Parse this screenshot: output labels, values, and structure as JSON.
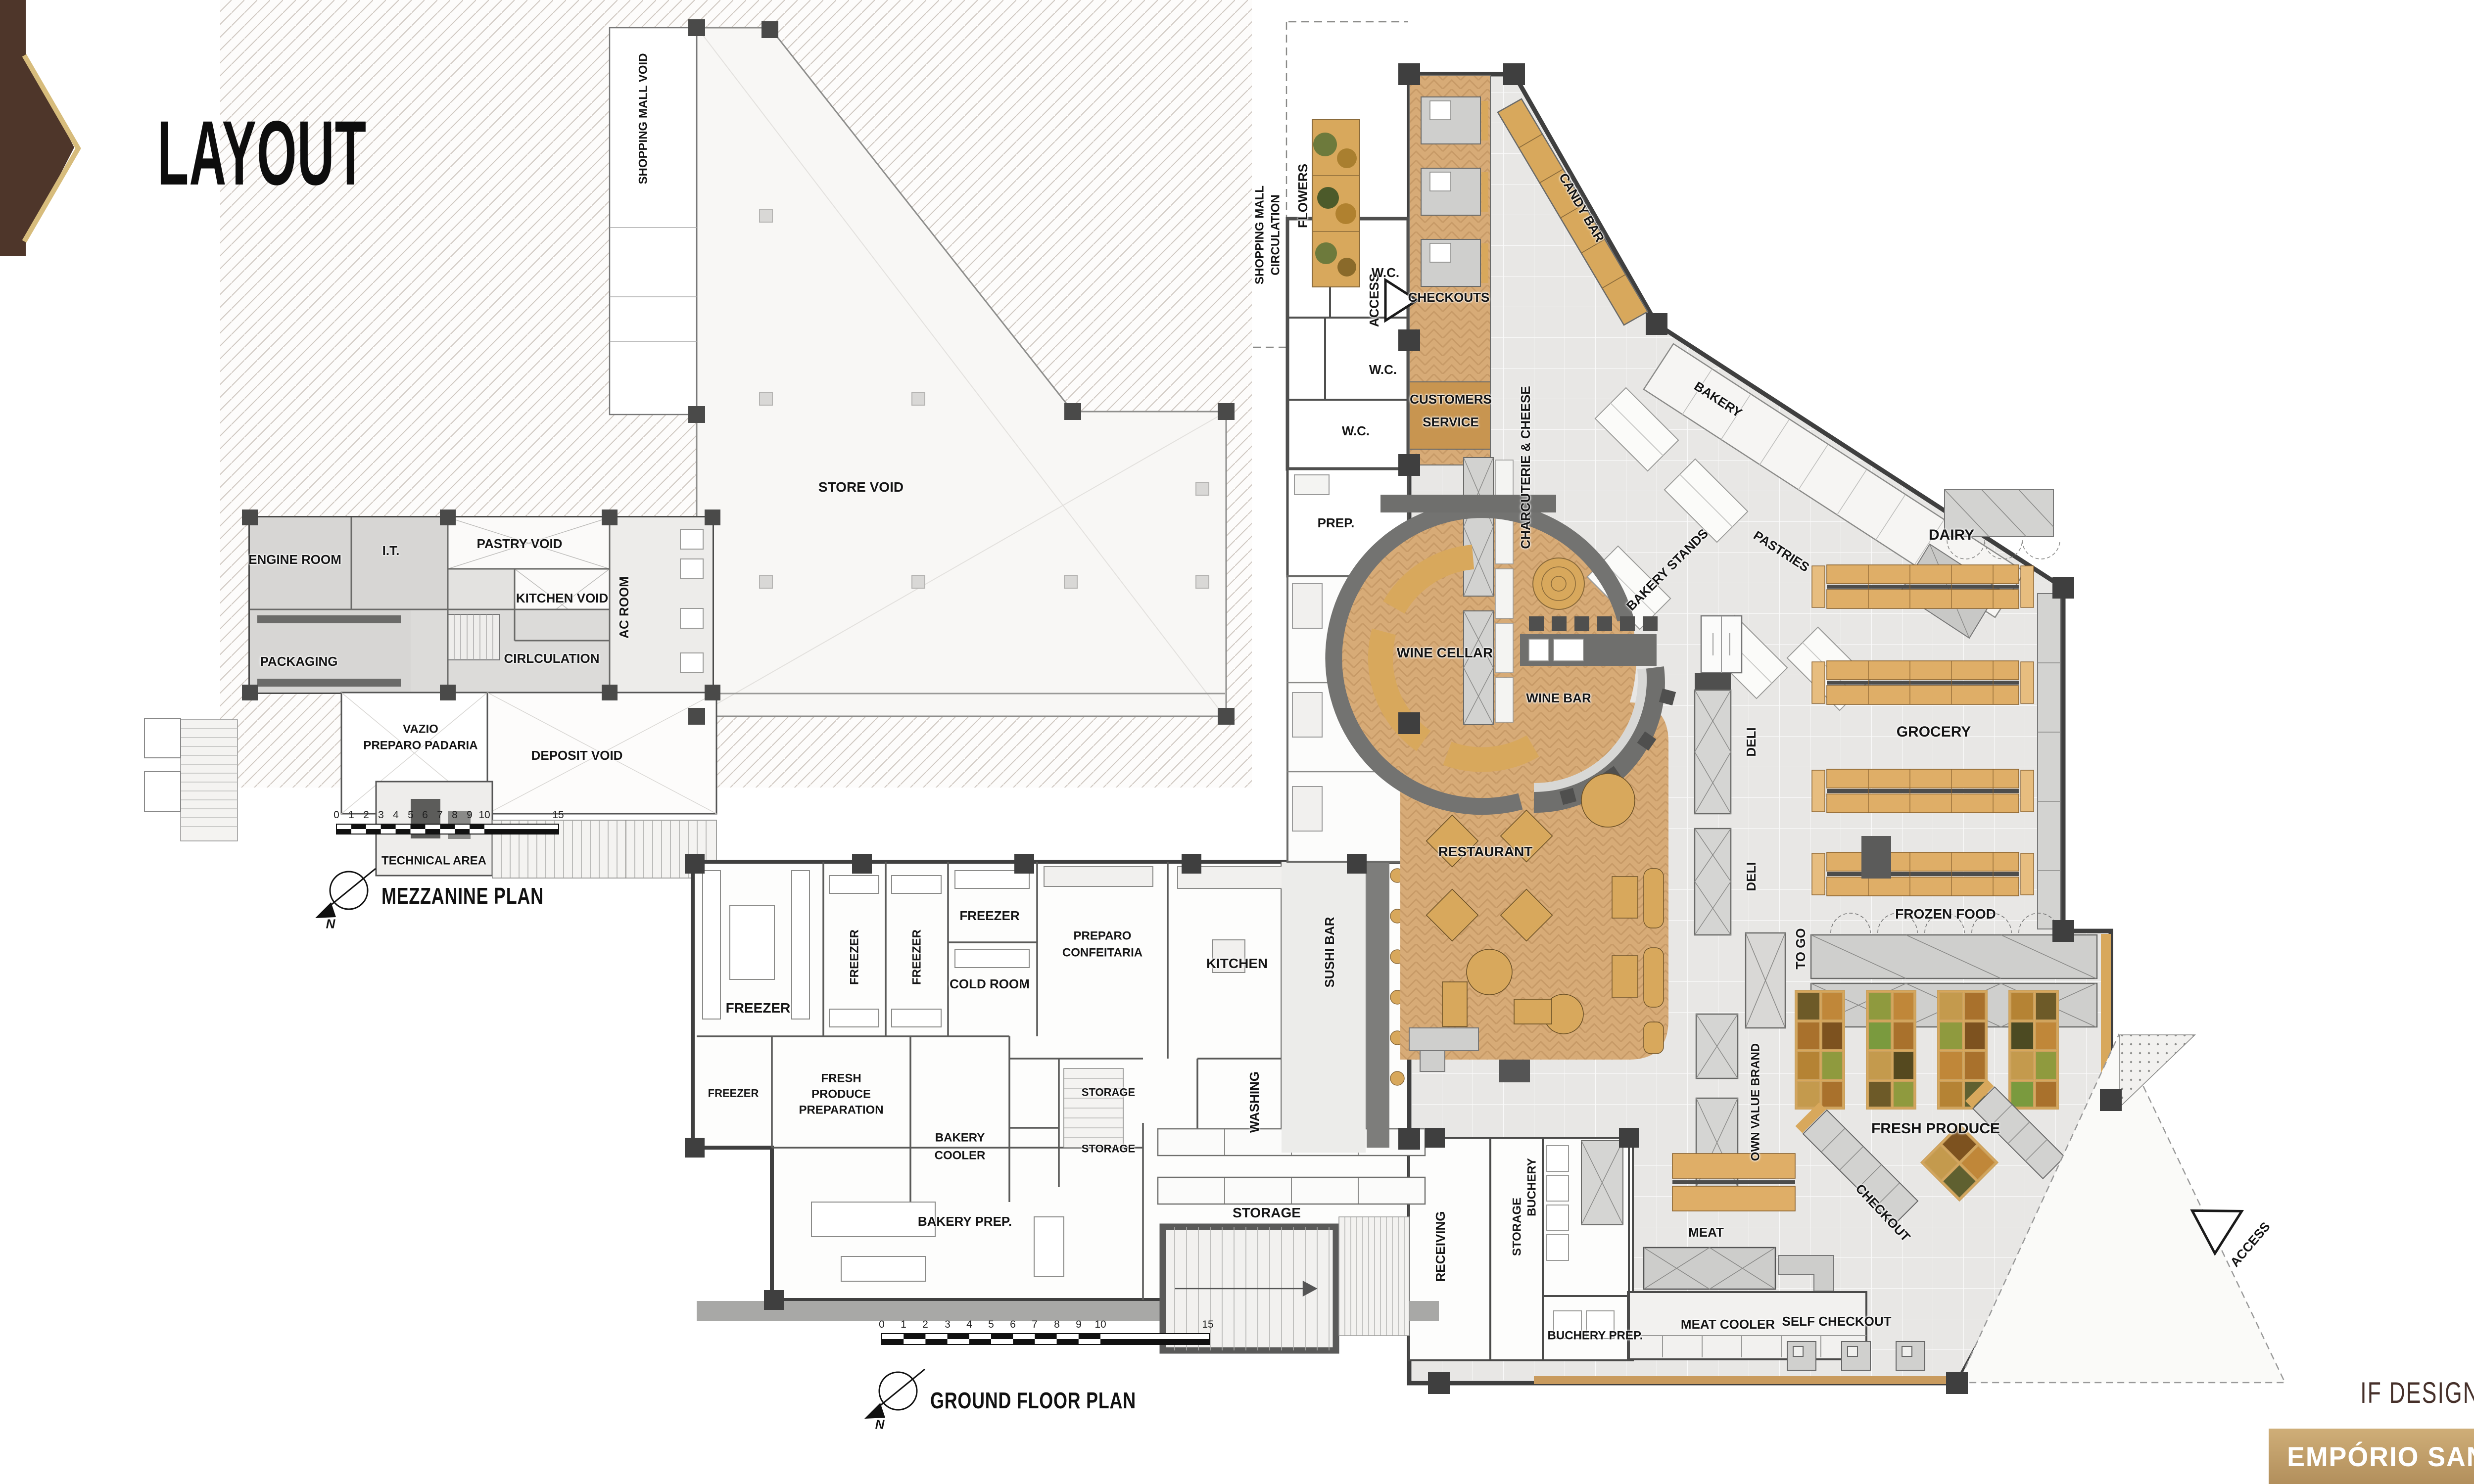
{
  "slide": {
    "title": "LAYOUT"
  },
  "footer": {
    "award": "IF DESIGN AWARD 2023",
    "brand": "EMPÓRIO SANTA MARIA"
  },
  "colors": {
    "accent_brown": "#4e362a",
    "accent_gold": "#d7bc7c",
    "band_tan": "#c2a16d",
    "wood": "#d7ab77",
    "shelf_orange": "#dfae67",
    "floor_gray": "#e8e7e5",
    "wall_dark": "#3f3f3f"
  },
  "mezzanine": {
    "title": "MEZZANINE PLAN",
    "north": "N",
    "scale_ticks": [
      "0",
      "1",
      "2",
      "3",
      "4",
      "5",
      "6",
      "7",
      "8",
      "9",
      "10",
      "15"
    ],
    "rooms": {
      "shopping_mall_void": "SHOPPING MALL VOID",
      "store_void": "STORE VOID",
      "engine_room": "ENGINE ROOM",
      "it": "I.T.",
      "pastry_void": "PASTRY VOID",
      "kitchen_void": "KITCHEN VOID",
      "ac_room": "AC ROOM",
      "packaging": "PACKAGING",
      "circulation": "CIRLCULATION",
      "vazio_1": "VAZIO",
      "vazio_2": "PREPARO PADARIA",
      "deposit_void": "DEPOSIT VOID",
      "technical_area": "TECHNICAL AREA"
    }
  },
  "ground": {
    "title": "GROUND FLOOR PLAN",
    "north": "N",
    "scale_ticks": [
      "0",
      "1",
      "2",
      "3",
      "4",
      "5",
      "6",
      "7",
      "8",
      "9",
      "10",
      "15"
    ],
    "areas": {
      "shopping_mall_1": "SHOPPING MALL",
      "shopping_mall_2": "CIRCULATION",
      "flowers": "FLOWERS",
      "access": "ACCESS",
      "checkouts": "CHECKOUTS",
      "candy_bar": "CANDY BAR",
      "customers_service_1": "CUSTOMERS",
      "customers_service_2": "SERVICE",
      "wc": "W.C.",
      "prep": "PREP.",
      "charcuterie_cheese": "CHARCUTERIE & CHEESE",
      "bakery": "BAKERY",
      "pastries": "PASTRIES",
      "bakery_stands": "BAKERY STANDS",
      "dairy": "DAIRY",
      "grocery": "GROCERY",
      "frozen_food": "FROZEN FOOD",
      "deli": "DELI",
      "to_go": "TO GO",
      "own_value_brand": "OWN VALUE BRAND",
      "fresh_produce": "FRESH PRODUCE",
      "wine_cellar": "WINE CELLAR",
      "wine_bar": "WINE BAR",
      "restaurant": "RESTAURANT",
      "sushi_bar": "SUSHI BAR",
      "kitchen": "KITCHEN",
      "freezer": "FREEZER",
      "cold_room": "COLD ROOM",
      "preparo_confeitaria_1": "PREPARO",
      "preparo_confeitaria_2": "CONFEITARIA",
      "fresh_produce_preparation_1": "FRESH",
      "fresh_produce_preparation_2": "PRODUCE",
      "fresh_produce_preparation_3": "PREPARATION",
      "bakery_cooler_1": "BAKERY",
      "bakery_cooler_2": "COOLER",
      "storage": "STORAGE",
      "bakery_prep": "BAKERY PREP.",
      "washing": "WASHING",
      "receiving": "RECEIVING",
      "buchery": "BUCHERY",
      "meat": "MEAT",
      "meat_cooler": "MEAT COOLER",
      "buchery_prep": "BUCHERY PREP.",
      "checkout": "CHECKOUT",
      "self_checkout": "SELF CHECKOUT"
    }
  }
}
